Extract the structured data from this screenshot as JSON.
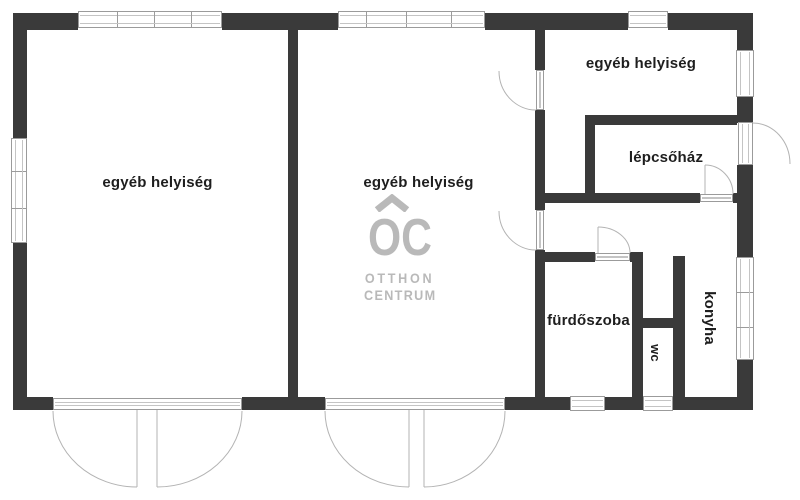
{
  "branding": {
    "logo_letters": "OC",
    "logo_line1": "OTTHON",
    "logo_line2": "CENTRUM"
  },
  "rooms": [
    {
      "id": "room-left",
      "label": "egyéb helyiség"
    },
    {
      "id": "room-middle",
      "label": "egyéb helyiség"
    },
    {
      "id": "room-top-right",
      "label": "egyéb helyiség"
    },
    {
      "id": "stairwell",
      "label": "lépcsőház"
    },
    {
      "id": "bathroom",
      "label": "fürdőszoba"
    },
    {
      "id": "wc",
      "label": "wc"
    },
    {
      "id": "kitchen",
      "label": "konyha"
    }
  ],
  "colors": {
    "wall": "#3a3a3a",
    "window_frame": "#9b9b9b",
    "window_line": "#c4c4c4",
    "door_arc": "#b3b3b3",
    "label": "#1e1e1e",
    "logo": "#b9b9b9",
    "background": "#ffffff"
  }
}
